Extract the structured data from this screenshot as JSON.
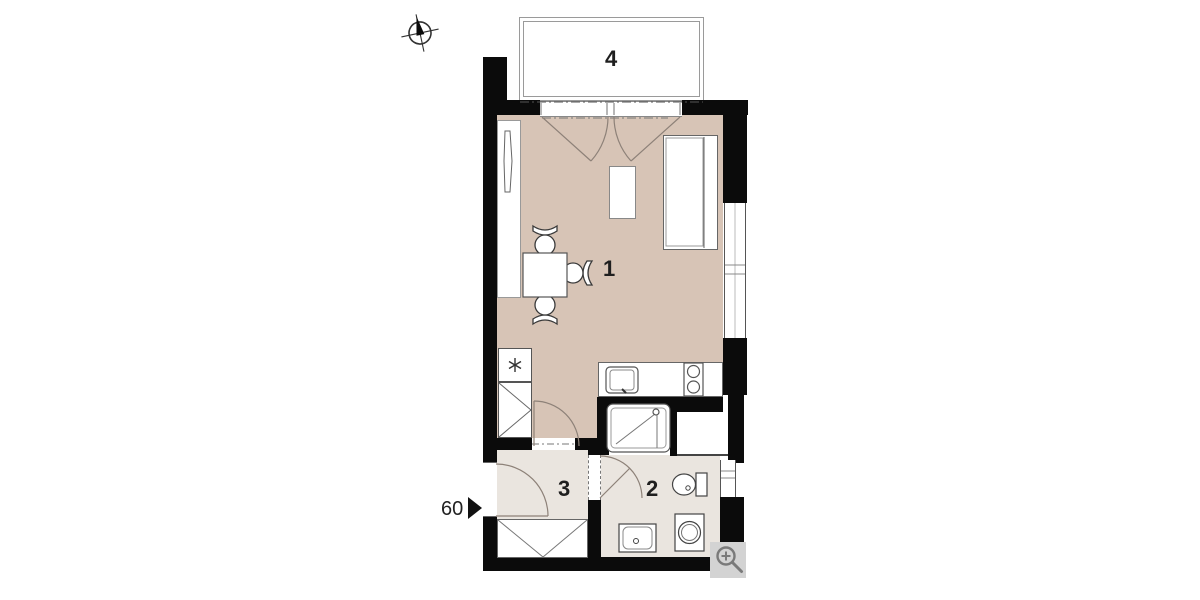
{
  "rooms": [
    {
      "id": "living-room",
      "label": "1"
    },
    {
      "id": "bathroom",
      "label": "2"
    },
    {
      "id": "hallway",
      "label": "3"
    },
    {
      "id": "balcony",
      "label": "4"
    }
  ],
  "scale_marker": {
    "value": "60"
  },
  "icons": {
    "compass": "compass-north-icon",
    "zoom_button": "magnifier-zoom-icon"
  },
  "colors": {
    "wall": "#0b0b0b",
    "living_floor": "#d7c4b6",
    "wet_floor": "#eae5df",
    "furniture_line": "#4a4a4a",
    "zoom_button_bg": "#d3d3d3"
  }
}
